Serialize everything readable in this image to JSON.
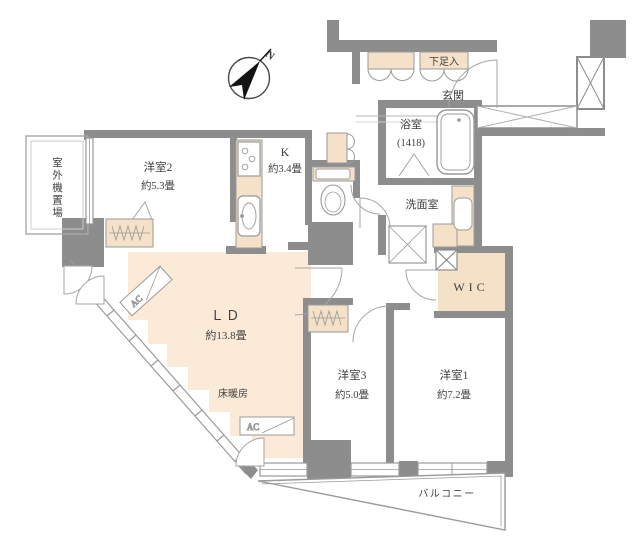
{
  "compass": {
    "north": "N"
  },
  "colors": {
    "wall": "#8d8d8d",
    "line": "#9a9a9a",
    "beige_fill": "#f4e1c8",
    "ld_fill": "#fcead9",
    "text": "#3f3f3f",
    "needle_black": "#141414"
  },
  "rooms": {
    "outdoor_unit": {
      "label": "室外機置場"
    },
    "bedroom2": {
      "label": "洋室2",
      "size": "約5.3畳"
    },
    "kitchen": {
      "label": "K",
      "size": "約3.4畳"
    },
    "shoe_cabinet": {
      "label": "下足入"
    },
    "entrance": {
      "label": "玄関"
    },
    "bathroom": {
      "label": "浴室",
      "size": "(1418)"
    },
    "washroom": {
      "label": "洗面室"
    },
    "wic": {
      "label": "WIC"
    },
    "living_dining": {
      "label": "ＬＤ",
      "size": "約13.8畳",
      "floor_heating": "床暖房"
    },
    "bedroom3": {
      "label": "洋室3",
      "size": "約5.0畳"
    },
    "bedroom1": {
      "label": "洋室1",
      "size": "約7.2畳"
    },
    "balcony": {
      "label": "バルコニー"
    },
    "air_conditioner": {
      "label": "AC"
    }
  }
}
